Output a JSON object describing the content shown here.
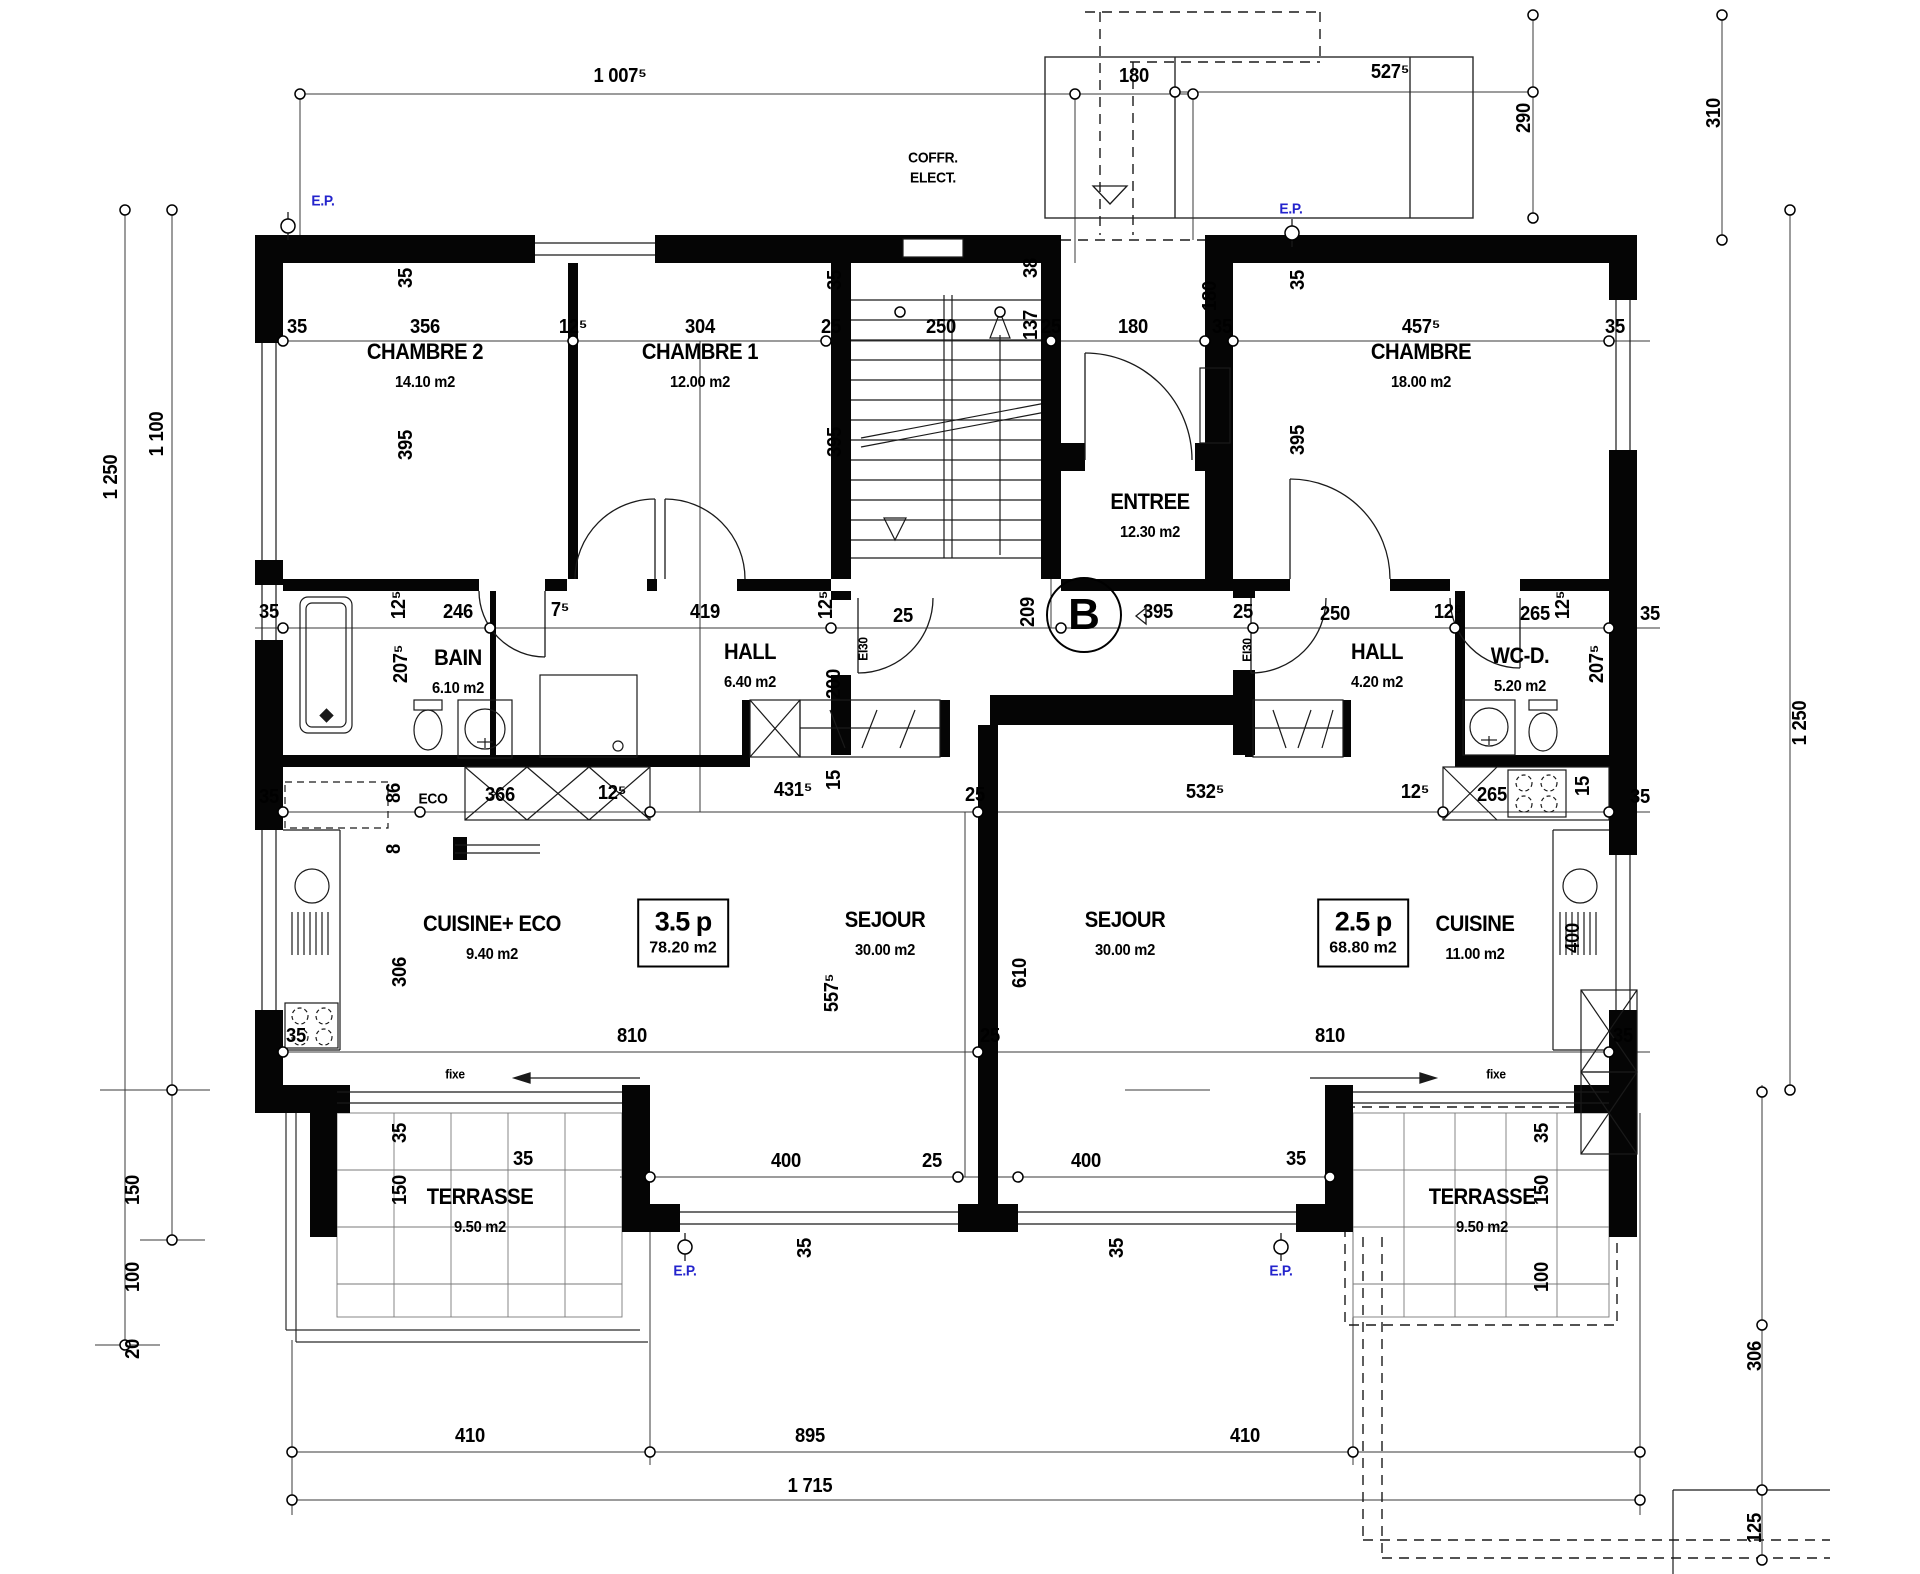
{
  "plan": {
    "building_label": "B",
    "colors": {
      "wall": "#000000",
      "dimension_line": "#3a3a3a",
      "accent_blue": "#2323cc"
    },
    "apartments": [
      {
        "label": "3.5 p",
        "area": "78.20 m2"
      },
      {
        "label": "2.5 p",
        "area": "68.80 m2"
      }
    ],
    "rooms": [
      {
        "name": "CHAMBRE 2",
        "area": "14.10 m2",
        "x": 425,
        "y": 352
      },
      {
        "name": "CHAMBRE 1",
        "area": "12.00 m2",
        "x": 700,
        "y": 352
      },
      {
        "name": "CHAMBRE",
        "area": "18.00 m2",
        "x": 1421,
        "y": 352
      },
      {
        "name": "ENTREE",
        "area": "12.30 m2",
        "x": 1150,
        "y": 502
      },
      {
        "name": "BAIN",
        "area": "6.10 m2",
        "x": 458,
        "y": 658
      },
      {
        "name": "HALL",
        "area": "6.40 m2",
        "x": 750,
        "y": 652
      },
      {
        "name": "HALL",
        "area": "4.20 m2",
        "x": 1377,
        "y": 652
      },
      {
        "name": "WC-D.",
        "area": "5.20 m2",
        "x": 1520,
        "y": 656
      },
      {
        "name": "CUISINE+ ECO",
        "area": "9.40 m2",
        "x": 492,
        "y": 924
      },
      {
        "name": "SEJOUR",
        "area": "30.00 m2",
        "x": 885,
        "y": 920
      },
      {
        "name": "SEJOUR",
        "area": "30.00 m2",
        "x": 1125,
        "y": 920
      },
      {
        "name": "CUISINE",
        "area": "11.00 m2",
        "x": 1475,
        "y": 924
      },
      {
        "name": "TERRASSE",
        "area": "9.50 m2",
        "x": 480,
        "y": 1197
      },
      {
        "name": "TERRASSE",
        "area": "9.50 m2",
        "x": 1482,
        "y": 1197
      }
    ],
    "annotations": [
      {
        "t": "1 007⁵",
        "x": 620,
        "y": 76
      },
      {
        "t": "180",
        "x": 1134,
        "y": 76
      },
      {
        "t": "527⁵",
        "x": 1390,
        "y": 72
      },
      {
        "t": "290",
        "x": 1524,
        "y": 118,
        "r": 1
      },
      {
        "t": "310",
        "x": 1714,
        "y": 113,
        "r": 1
      },
      {
        "t": "E.P.",
        "x": 323,
        "y": 201,
        "c": "blue"
      },
      {
        "t": "E.P.",
        "x": 1291,
        "y": 209,
        "c": "blue"
      },
      {
        "t": "COFFR.",
        "x": 933,
        "y": 158,
        "c": "lbl"
      },
      {
        "t": "ELECT.",
        "x": 933,
        "y": 178,
        "c": "lbl"
      },
      {
        "t": "35",
        "x": 297,
        "y": 327
      },
      {
        "t": "356",
        "x": 425,
        "y": 327
      },
      {
        "t": "12⁵",
        "x": 573,
        "y": 327
      },
      {
        "t": "304",
        "x": 700,
        "y": 327
      },
      {
        "t": "25",
        "x": 831,
        "y": 327
      },
      {
        "t": "250",
        "x": 941,
        "y": 327
      },
      {
        "t": "38",
        "x": 1031,
        "y": 268,
        "r": 1
      },
      {
        "t": "137",
        "x": 1031,
        "y": 325,
        "r": 1
      },
      {
        "t": "25",
        "x": 1051,
        "y": 327
      },
      {
        "t": "180",
        "x": 1133,
        "y": 327
      },
      {
        "t": "180",
        "x": 1210,
        "y": 296,
        "r": 1
      },
      {
        "t": "35",
        "x": 1222,
        "y": 327
      },
      {
        "t": "457⁵",
        "x": 1421,
        "y": 327
      },
      {
        "t": "35",
        "x": 1615,
        "y": 327
      },
      {
        "t": "35",
        "x": 406,
        "y": 278,
        "r": 1
      },
      {
        "t": "395",
        "x": 406,
        "y": 445,
        "r": 1
      },
      {
        "t": "35",
        "x": 835,
        "y": 280,
        "r": 1
      },
      {
        "t": "395",
        "x": 835,
        "y": 442,
        "r": 1
      },
      {
        "t": "35",
        "x": 1298,
        "y": 280,
        "r": 1
      },
      {
        "t": "395",
        "x": 1298,
        "y": 440,
        "r": 1
      },
      {
        "t": "1 250",
        "x": 111,
        "y": 477,
        "r": 1
      },
      {
        "t": "1 100",
        "x": 157,
        "y": 434,
        "r": 1
      },
      {
        "t": "35",
        "x": 269,
        "y": 612
      },
      {
        "t": "12⁵",
        "x": 399,
        "y": 605,
        "r": 1
      },
      {
        "t": "246",
        "x": 458,
        "y": 612
      },
      {
        "t": "7⁵",
        "x": 560,
        "y": 610
      },
      {
        "t": "419",
        "x": 705,
        "y": 612
      },
      {
        "t": "12⁵",
        "x": 826,
        "y": 605,
        "r": 1
      },
      {
        "t": "25",
        "x": 903,
        "y": 616
      },
      {
        "t": "EI30",
        "x": 863,
        "y": 649,
        "r": 1,
        "c": "small"
      },
      {
        "t": "209",
        "x": 1028,
        "y": 612,
        "r": 1
      },
      {
        "t": "395",
        "x": 1158,
        "y": 612
      },
      {
        "t": "25",
        "x": 1243,
        "y": 612
      },
      {
        "t": "EI30",
        "x": 1247,
        "y": 650,
        "r": 1,
        "c": "small"
      },
      {
        "t": "250",
        "x": 1335,
        "y": 614
      },
      {
        "t": "12⁵",
        "x": 1448,
        "y": 612
      },
      {
        "t": "265",
        "x": 1535,
        "y": 614
      },
      {
        "t": "12⁵",
        "x": 1563,
        "y": 605,
        "r": 1
      },
      {
        "t": "35",
        "x": 1650,
        "y": 614
      },
      {
        "t": "207⁵",
        "x": 401,
        "y": 664,
        "r": 1
      },
      {
        "t": "207⁵",
        "x": 1597,
        "y": 664,
        "r": 1
      },
      {
        "t": "200",
        "x": 834,
        "y": 684,
        "r": 1
      },
      {
        "t": "15",
        "x": 834,
        "y": 780,
        "r": 1
      },
      {
        "t": "15",
        "x": 1583,
        "y": 786,
        "r": 1
      },
      {
        "t": "35",
        "x": 269,
        "y": 797
      },
      {
        "t": "86",
        "x": 394,
        "y": 793,
        "r": 1
      },
      {
        "t": "8",
        "x": 394,
        "y": 849,
        "r": 1
      },
      {
        "t": "ECO",
        "x": 433,
        "y": 799,
        "c": "lbl"
      },
      {
        "t": "366",
        "x": 500,
        "y": 795
      },
      {
        "t": "12⁵",
        "x": 612,
        "y": 793
      },
      {
        "t": "431⁵",
        "x": 793,
        "y": 790
      },
      {
        "t": "25",
        "x": 975,
        "y": 795
      },
      {
        "t": "532⁵",
        "x": 1205,
        "y": 792
      },
      {
        "t": "12⁵",
        "x": 1415,
        "y": 792
      },
      {
        "t": "265",
        "x": 1492,
        "y": 795
      },
      {
        "t": "35",
        "x": 1640,
        "y": 797
      },
      {
        "t": "306",
        "x": 400,
        "y": 972,
        "r": 1
      },
      {
        "t": "557⁵",
        "x": 832,
        "y": 993,
        "r": 1
      },
      {
        "t": "610",
        "x": 1020,
        "y": 973,
        "r": 1
      },
      {
        "t": "400",
        "x": 1573,
        "y": 938,
        "r": 1
      },
      {
        "t": "35",
        "x": 296,
        "y": 1036
      },
      {
        "t": "810",
        "x": 632,
        "y": 1036
      },
      {
        "t": "25",
        "x": 990,
        "y": 1036
      },
      {
        "t": "810",
        "x": 1330,
        "y": 1036
      },
      {
        "t": "35",
        "x": 1623,
        "y": 1036
      },
      {
        "t": "35",
        "x": 523,
        "y": 1159
      },
      {
        "t": "400",
        "x": 786,
        "y": 1161
      },
      {
        "t": "25",
        "x": 932,
        "y": 1161
      },
      {
        "t": "400",
        "x": 1086,
        "y": 1161
      },
      {
        "t": "35",
        "x": 1296,
        "y": 1159
      },
      {
        "t": "35",
        "x": 805,
        "y": 1248,
        "r": 1
      },
      {
        "t": "35",
        "x": 1117,
        "y": 1248,
        "r": 1
      },
      {
        "t": "35",
        "x": 400,
        "y": 1133,
        "r": 1
      },
      {
        "t": "150",
        "x": 400,
        "y": 1190,
        "r": 1
      },
      {
        "t": "fixe",
        "x": 455,
        "y": 1074,
        "c": "small"
      },
      {
        "t": "fixe",
        "x": 1496,
        "y": 1074,
        "c": "small"
      },
      {
        "t": "35",
        "x": 1542,
        "y": 1133,
        "r": 1
      },
      {
        "t": "150",
        "x": 1542,
        "y": 1190,
        "r": 1
      },
      {
        "t": "100",
        "x": 1542,
        "y": 1277,
        "r": 1
      },
      {
        "t": "150",
        "x": 133,
        "y": 1190,
        "r": 1
      },
      {
        "t": "100",
        "x": 133,
        "y": 1277,
        "r": 1
      },
      {
        "t": "20",
        "x": 133,
        "y": 1349,
        "r": 1
      },
      {
        "t": "E.P.",
        "x": 685,
        "y": 1271,
        "c": "blue"
      },
      {
        "t": "E.P.",
        "x": 1281,
        "y": 1271,
        "c": "blue"
      },
      {
        "t": "410",
        "x": 470,
        "y": 1436
      },
      {
        "t": "895",
        "x": 810,
        "y": 1436
      },
      {
        "t": "410",
        "x": 1245,
        "y": 1436
      },
      {
        "t": "1 715",
        "x": 810,
        "y": 1486
      },
      {
        "t": "1 250",
        "x": 1800,
        "y": 723,
        "r": 1
      },
      {
        "t": "306",
        "x": 1755,
        "y": 1356,
        "r": 1
      },
      {
        "t": "125",
        "x": 1755,
        "y": 1528,
        "r": 1
      }
    ]
  }
}
